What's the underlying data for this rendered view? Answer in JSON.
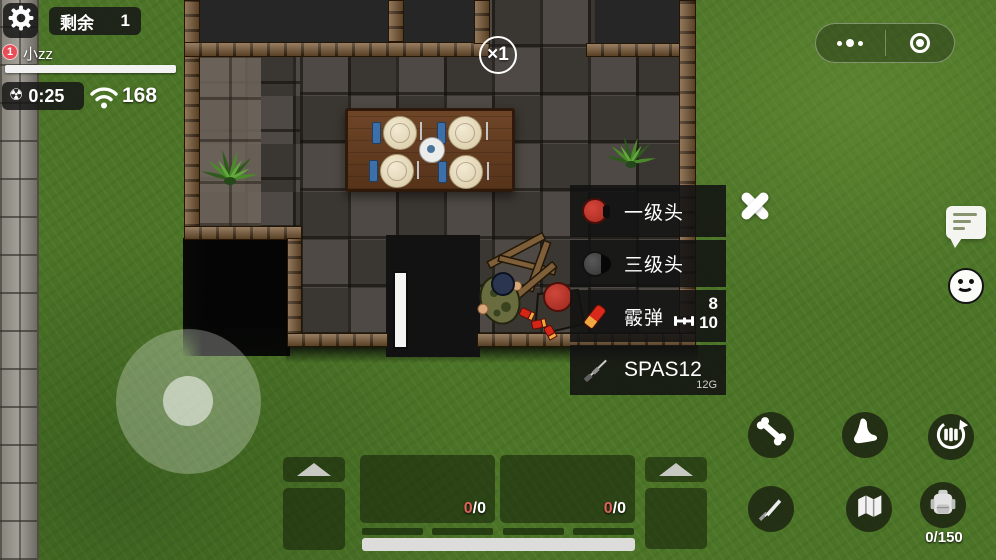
{
  "hud": {
    "remaining_label": "剩余",
    "remaining_value": "1",
    "player_badge": "1",
    "player_name": "小zz",
    "radiation_glyph": "☢",
    "radiation_time": "0:25",
    "signal_strength": "168",
    "multiplier_badge": "×1"
  },
  "loot_panel": {
    "items": [
      {
        "name": "一级头",
        "icon": "helmet-level-1"
      },
      {
        "name": "三级头",
        "icon": "helmet-level-3"
      },
      {
        "name": "霰弹",
        "icon": "shotgun-shell",
        "count": "8",
        "capacity": "10"
      },
      {
        "name": "SPAS12",
        "icon": "shotgun",
        "caliber": "12G"
      }
    ]
  },
  "bottom_bar": {
    "weapon_slots": [
      {
        "ammo_current": "0",
        "ammo_rest": "/0"
      },
      {
        "ammo_current": "0",
        "ammo_rest": "/0"
      }
    ]
  },
  "action_buttons": {
    "icons": [
      "bone-icon",
      "foot-icon",
      "reload-icon",
      "knife-icon",
      "map-icon",
      "backpack-icon"
    ],
    "backpack_capacity": "0/150"
  },
  "colors": {
    "grass": "#4c7427",
    "hp_bar": "#f2f2f2",
    "ammo_current_red": "#e0625c",
    "helmet1_red": "#c03a30",
    "panel_bg": "#161616",
    "wall_brick": "#7b5a36"
  }
}
